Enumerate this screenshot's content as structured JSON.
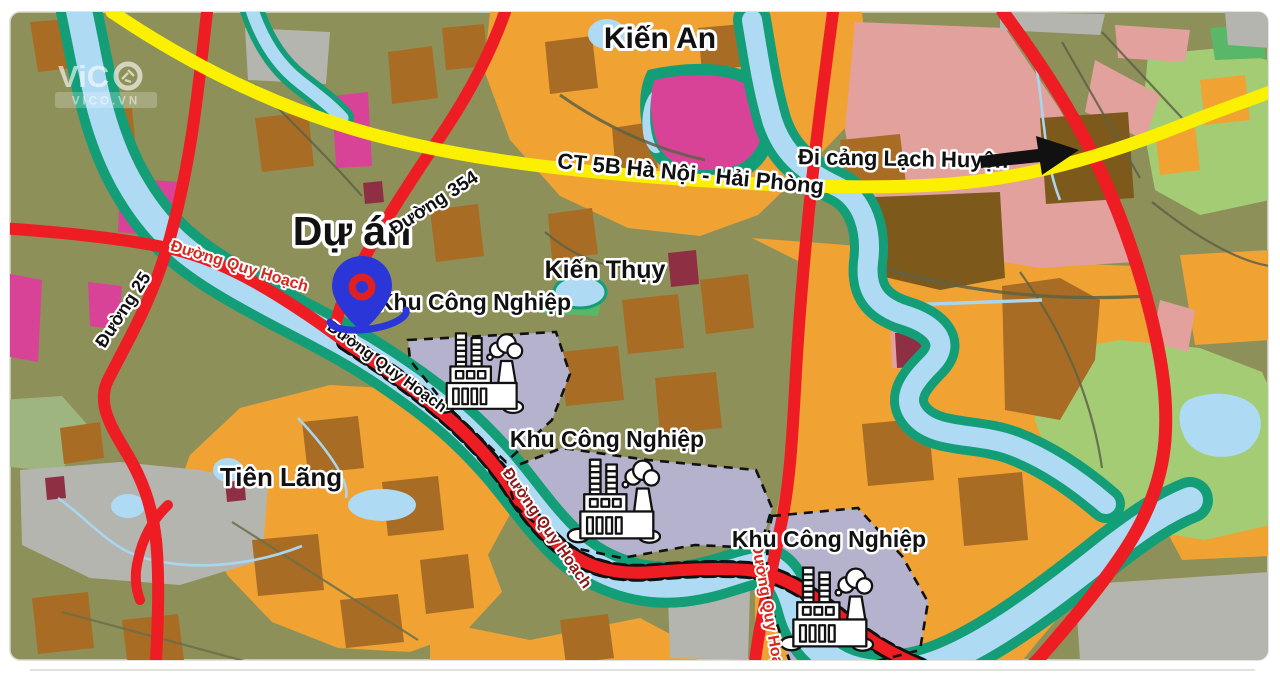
{
  "map_type": "land-use planning map (Hải Phòng area, Việt Nam)",
  "watermark": {
    "logo_text": "ViC",
    "logo_o": "aperture-ring",
    "domain": "VICO.VN"
  },
  "project": {
    "label": "Dự án"
  },
  "places": {
    "kien_an": "Kiến An",
    "kien_thuy": "Kiến Thụy",
    "tien_lang": "Tiên Lãng"
  },
  "roads": {
    "highway": "CT 5B Hà Nội - Hải Phòng",
    "road_354": "Đường 354",
    "road_25": "Đường 25",
    "planned_road": "Đường Quy Hoạch"
  },
  "annotations": {
    "port_direction": "Đi cảng Lạch Huyện"
  },
  "zones": {
    "industrial": "Khu Công Nghiệp"
  },
  "colors": {
    "olive_land": "#8E9059",
    "orange_zone": "#F0A233",
    "brown_parcel": "#A86C24",
    "dark_brown_parcel": "#7D5A1C",
    "salmon_zone": "#E2A19D",
    "magenta_zone": "#D84397",
    "lavender_industrial": "#B4B2CD",
    "gray_zone": "#B5B5B0",
    "light_green_zone": "#A4CC74",
    "water_blue": "#AEDAF3",
    "river_bank_teal": "#149E78",
    "road_red": "#EE1D23",
    "highway_yellow": "#FBF000",
    "pin_blue": "#2B36D8",
    "pin_red": "#E02020"
  }
}
